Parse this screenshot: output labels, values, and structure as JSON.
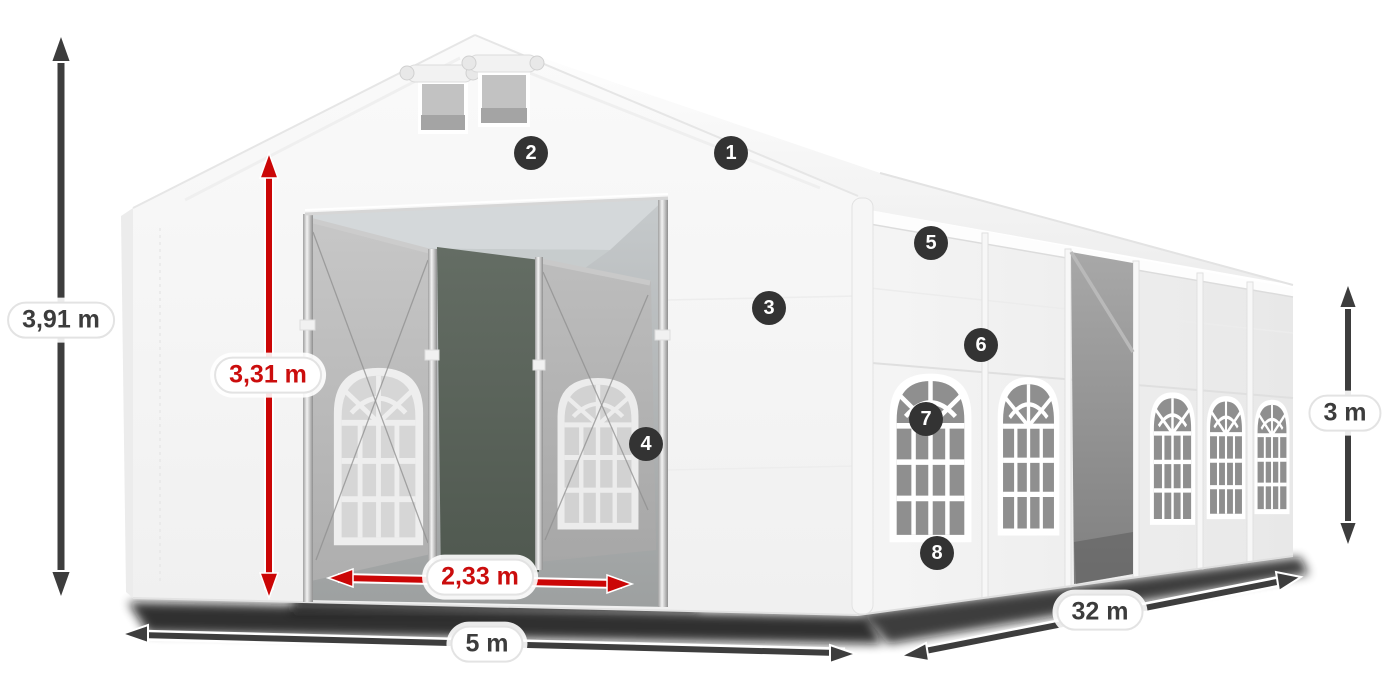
{
  "dimensions": {
    "total_height": {
      "label": "3,91 m",
      "style": "dark"
    },
    "inner_height": {
      "label": "3,31 m",
      "style": "red"
    },
    "door_width": {
      "label": "2,33 m",
      "style": "red"
    },
    "width": {
      "label": "5 m",
      "style": "dark"
    },
    "length": {
      "label": "32 m",
      "style": "dark"
    },
    "side_height": {
      "label": "3 m",
      "style": "dark"
    }
  },
  "hotspots": [
    {
      "label": "1"
    },
    {
      "label": "2"
    },
    {
      "label": "3"
    },
    {
      "label": "4"
    },
    {
      "label": "5"
    },
    {
      "label": "6"
    },
    {
      "label": "7"
    },
    {
      "label": "8"
    }
  ],
  "colors": {
    "dimension_dark": "#3d3d3d",
    "dimension_red": "#cb0606",
    "badge_background": "#333333",
    "badge_text": "#ffffff"
  }
}
